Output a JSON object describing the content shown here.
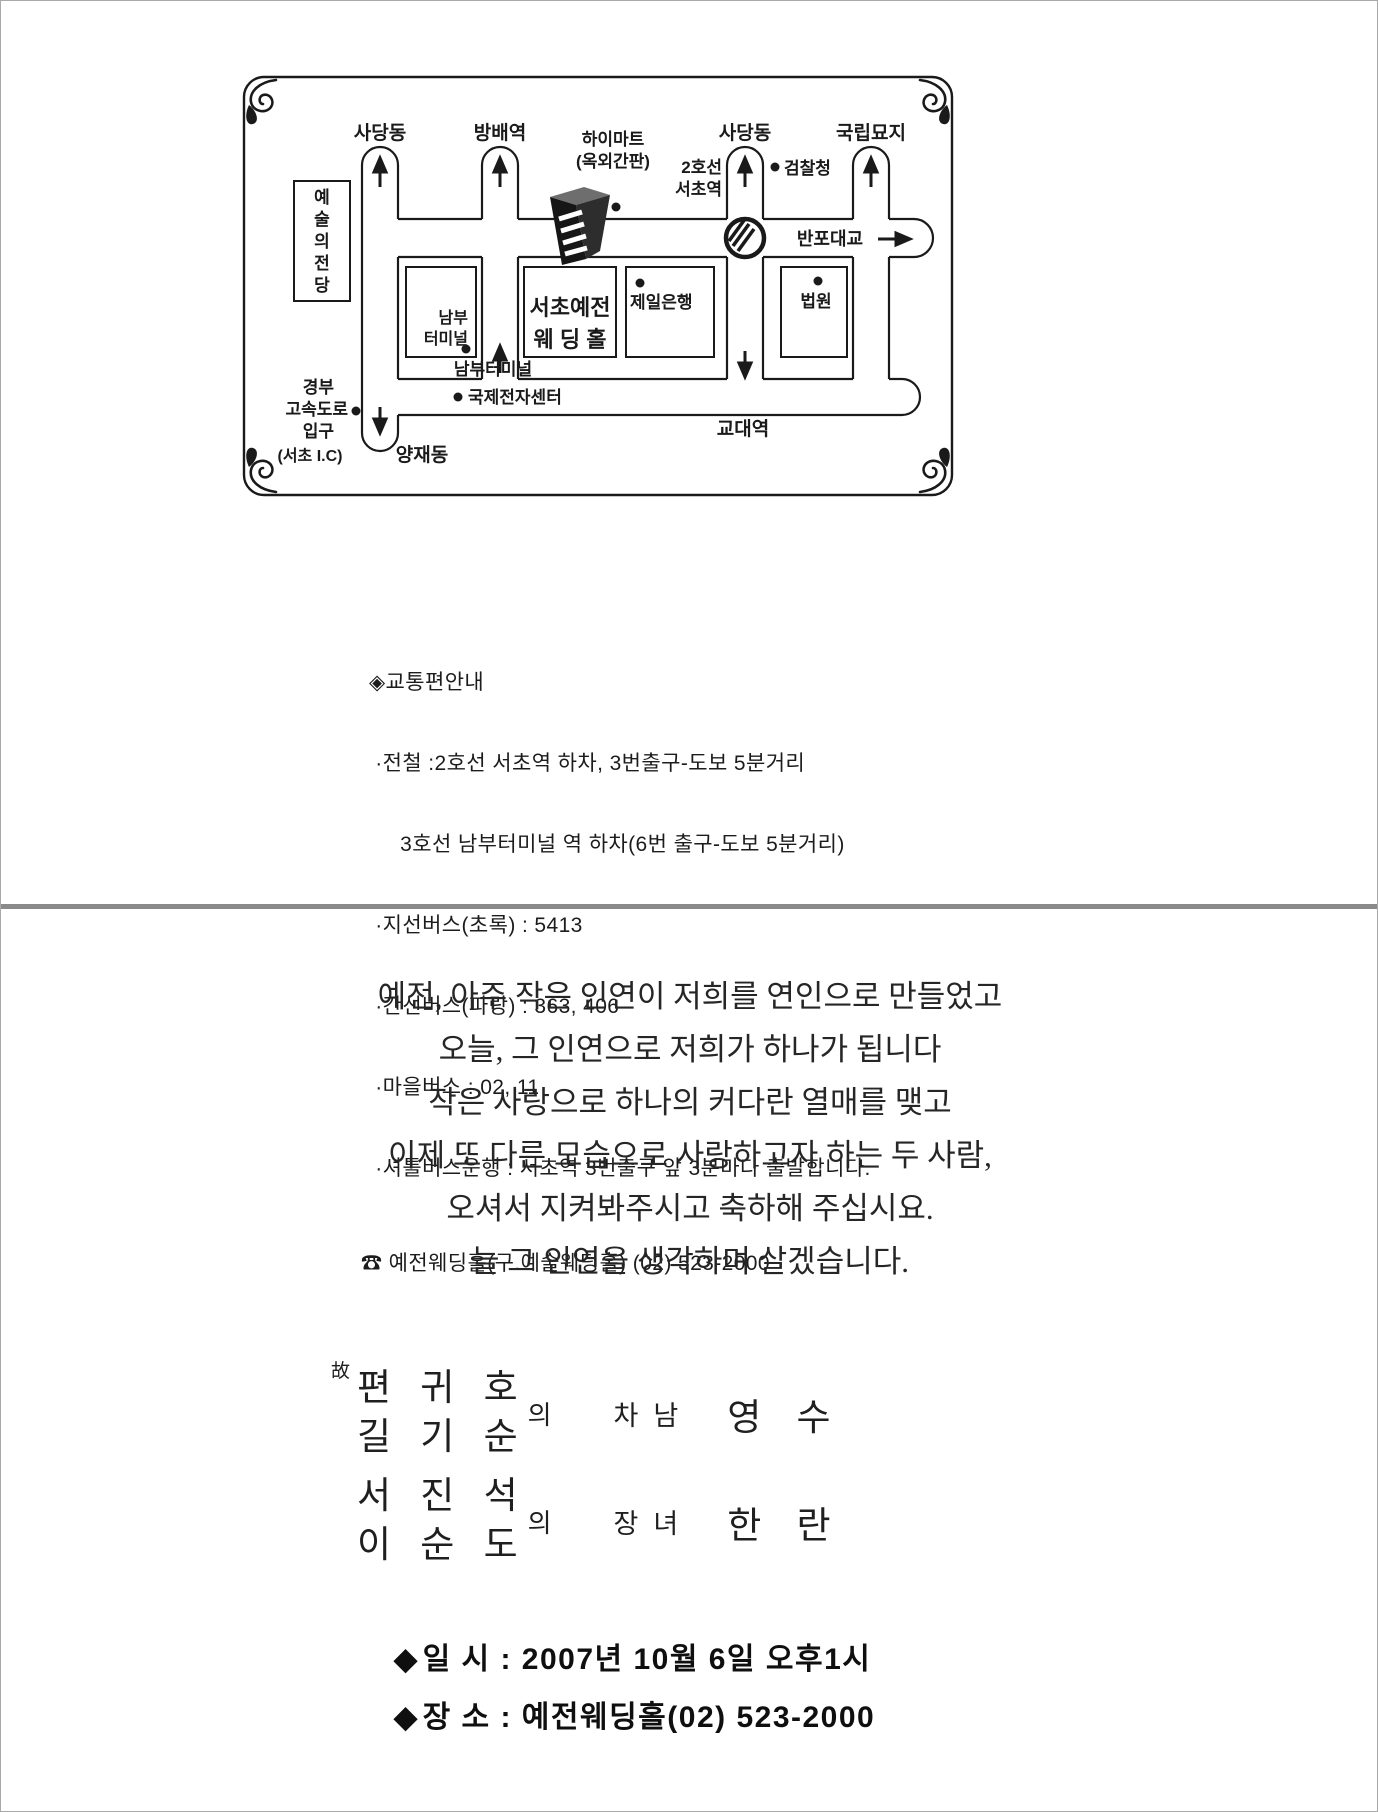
{
  "map": {
    "sadang_left": "사당동",
    "bangbae": "방배역",
    "sadang_right": "사당동",
    "cemetery": "국립묘지",
    "himart1": "하이마트",
    "himart2": "(옥외간판)",
    "line2a": "2호선",
    "line2b": "서초역",
    "prosecutors": "검찰청",
    "banpo": "반포대교",
    "arts": [
      "예",
      "술",
      "의",
      "전",
      "당"
    ],
    "nambu1": "남부",
    "nambu2": "터미널",
    "wedding1": "서초예전",
    "wedding2": "웨 딩 홀",
    "bank": "제일은행",
    "court": "법원",
    "nambu_road": "남부터미널",
    "intl_elec": "국제전자센터",
    "gyodae": "교대역",
    "gyeongbu1": "경부",
    "gyeongbu2": "고속도로",
    "gyeongbu3": "입구",
    "seocho_ic": "(서초 I.C)",
    "yangjae": "양재동"
  },
  "transport": {
    "title": "◈교통편안내",
    "lines": [
      " ·전철 :2호선 서초역 하차, 3번출구-도보 5분거리",
      "     3호선 남부터미널 역 하차(6번 출구-도보 5분거리)",
      " ·지선버스(초록) : 5413",
      " ·간선버스(파랑) : 363, 406",
      " ·마을버스 : 02, 11",
      " ·셔틀버스운행 : 서초역 3번출구 앞 3분마다 출발합니다."
    ],
    "phone": "☎ 예전웨딩홀(구.예술웨딩홀) (02) 523-2000"
  },
  "message": {
    "lines": [
      "예전, 아주 작은 인연이 저희를 연인으로 만들었고",
      "오늘, 그 인연으로 저희가 하나가 됩니다",
      "작은 사랑으로 하나의 커다란 열매를 맺고",
      "이제 또 다른 모습으로 사랑하고자 하는 두 사람,",
      "오셔서 지켜봐주시고 축하해 주십시요.",
      "늘 그 인연을 생각하며 살겠습니다."
    ]
  },
  "families": {
    "groom": {
      "deceased": "故",
      "father": "편 귀 호",
      "mother": "길 기 순",
      "of": "의",
      "relation": "차남",
      "name": "영 수"
    },
    "bride": {
      "father": "서 진 석",
      "mother": "이 순 도",
      "of": "의",
      "relation": "장녀",
      "name": "한 란"
    }
  },
  "details": {
    "diamond": "◆",
    "date": "일 시 : 2007년 10월 6일 오후1시",
    "venue": "장 소 : 예전웨딩홀(02) 523-2000"
  }
}
